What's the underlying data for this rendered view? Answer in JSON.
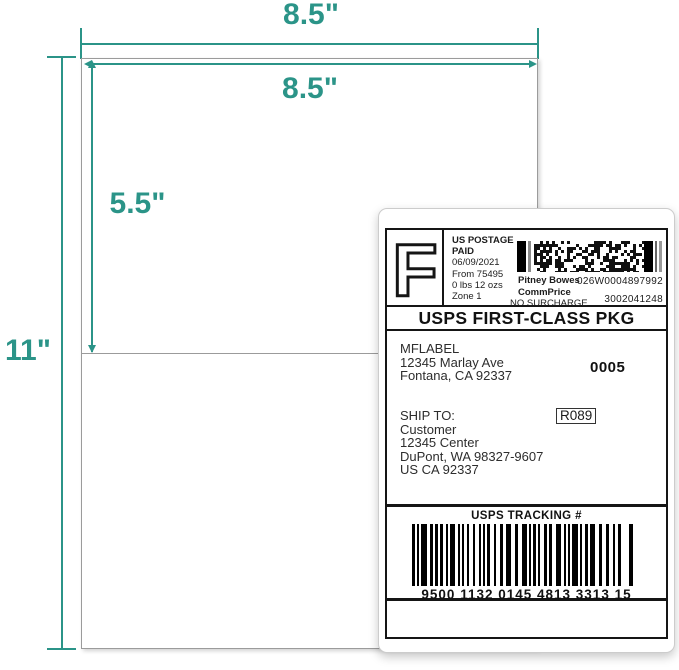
{
  "colors": {
    "accent_teal": "#2B9488",
    "label_ink": "#151515"
  },
  "annotations": {
    "sheet_width": "8.5\"",
    "label_width": "8.5\"",
    "label_height": "5.5\"",
    "sheet_height": "11\""
  },
  "shipping_label": {
    "postage": {
      "letter": "F",
      "line1": "US POSTAGE",
      "line2": "PAID",
      "date": "06/09/2021",
      "origin": "From 75495",
      "weight": "0 lbs 12 ozs",
      "zone": "Zone 1",
      "carrier": "Pitney Bowes",
      "meter_number": "026W0004897992",
      "rate": "CommPrice",
      "surcharge": "NO SURCHARGE",
      "account_number": "3002041248"
    },
    "service_class": "USPS FIRST-CLASS PKG",
    "sender": {
      "name": "MFLABEL",
      "address1": "12345 Marlay Ave",
      "address2": "Fontana, CA 92337",
      "batch_number": "0005"
    },
    "recipient": {
      "label": "SHIP TO:",
      "name": "Customer",
      "address1": "12345 Center",
      "address2": "DuPont, WA 98327-9607",
      "address3": "US CA 92337",
      "route_code": "R089"
    },
    "tracking": {
      "header": "USPS TRACKING #",
      "number": "9500 1132 0145 4813 3313 15"
    }
  }
}
